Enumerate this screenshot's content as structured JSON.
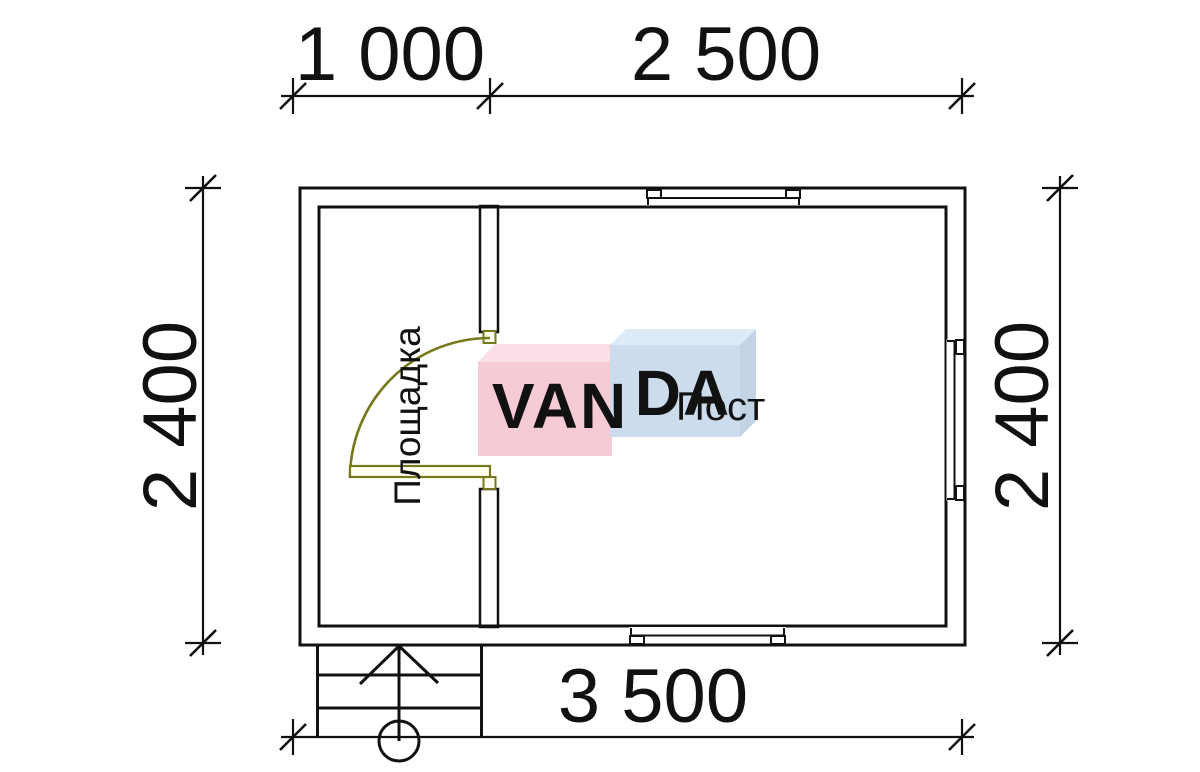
{
  "plan": {
    "dimensions": {
      "top_segment_left": "1 000",
      "top_segment_right": "2 500",
      "left_side": "2 400",
      "right_side": "2 400",
      "bottom_total": "3 500"
    },
    "rooms": {
      "porch": "Площадка",
      "main_room": "Пост"
    }
  },
  "watermark": {
    "left_block_text": "VAN",
    "right_block_text": "DA"
  },
  "colors": {
    "line_black": "#111111",
    "wall_fill": "#fbfaec",
    "wall_hatch": "#9b9b4e",
    "door_olive": "#77771c",
    "door_leaf_fill": "#fffdf0",
    "watermark_pink_front": "#f7cbd6",
    "watermark_pink_top": "#fadfe6",
    "watermark_blue_front": "#cddcec",
    "watermark_blue_top": "#ddebf7",
    "watermark_blue_side": "#c2d3e6",
    "watermark_text": "#ffffff"
  }
}
